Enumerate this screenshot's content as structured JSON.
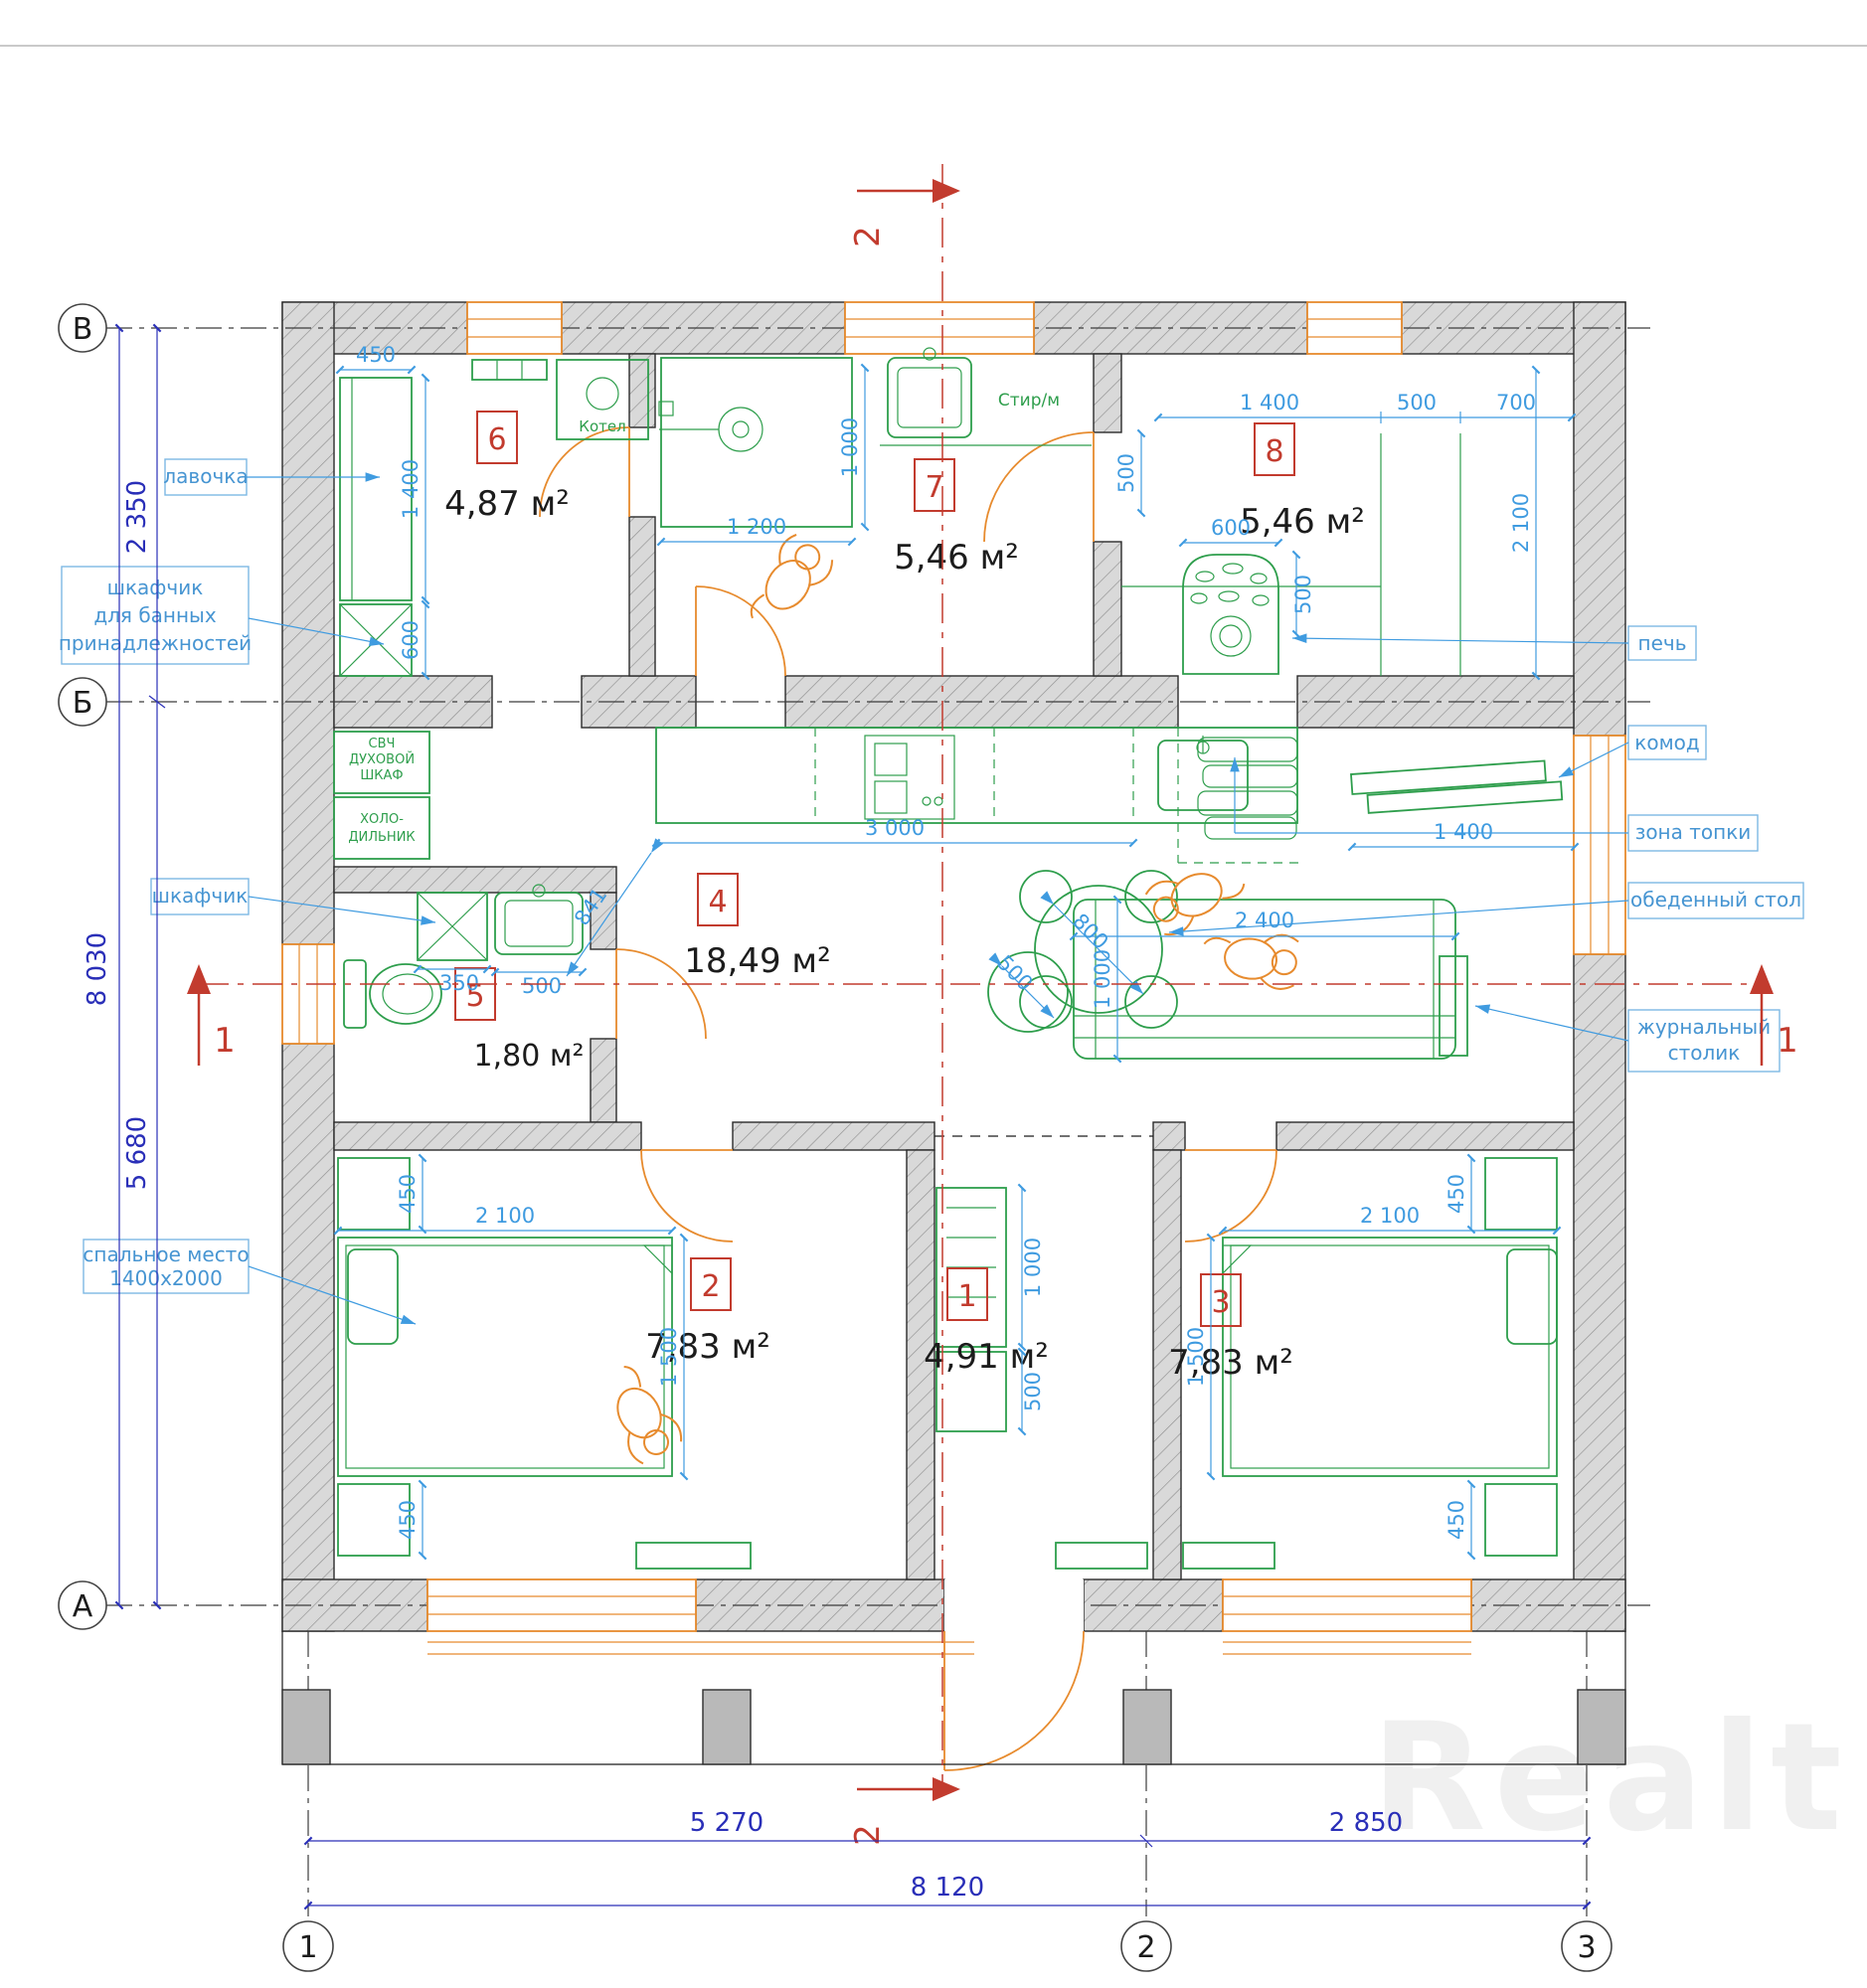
{
  "watermark": "Realt",
  "axes": {
    "vertical_letters": [
      "В",
      "Б",
      "А"
    ],
    "horizontal_numbers": [
      "1",
      "2",
      "3"
    ]
  },
  "sections": {
    "s1": "1",
    "s2": "2"
  },
  "rooms": [
    {
      "num": "1",
      "area": "4,91 м²"
    },
    {
      "num": "2",
      "area": "7,83 м²"
    },
    {
      "num": "3",
      "area": "7,83 м²"
    },
    {
      "num": "4",
      "area": "18,49 м²"
    },
    {
      "num": "5",
      "area": "1,80 м²"
    },
    {
      "num": "6",
      "area": "4,87 м²"
    },
    {
      "num": "7",
      "area": "5,46 м²"
    },
    {
      "num": "8",
      "area": "5,46 м²"
    }
  ],
  "callouts": {
    "lavochka": "лавочка",
    "bath_cabinet": [
      "шкафчик",
      "для банных",
      "принадлежностей"
    ],
    "shkafchik": "шкафчик",
    "sleeping": [
      "спальное место",
      "1400х2000"
    ],
    "pech": "печь",
    "komod": "комод",
    "zona_topki": "зона топки",
    "dining_table": "обеденный стол",
    "coffee_table": [
      "журнальный",
      "столик"
    ]
  },
  "equipment": {
    "kotel": "Котел",
    "stir": "Стир/м",
    "svch": [
      "СВЧ",
      "ДУХОВОЙ",
      "ШКАФ"
    ],
    "fridge": [
      "ХОЛО-",
      "ДИЛЬНИК"
    ]
  },
  "dims": {
    "d350": "350",
    "d450": "450",
    "d500": "500",
    "d600": "600",
    "d700": "700",
    "d800": "800",
    "d841": "841",
    "d1000": "1 000",
    "d1200": "1 200",
    "d1400": "1 400",
    "d1500": "1 500",
    "d2100": "2 100",
    "d2400": "2 400",
    "d3000": "3 000",
    "d2350": "2 350",
    "d5680": "5 680",
    "d8030": "8 030",
    "d5270": "5 270",
    "d2850": "2 850",
    "d8120": "8 120"
  },
  "colors": {
    "green": "#2e9e4c",
    "orange": "#e78b2e",
    "dim_blue": "#3f9be0",
    "main_blue": "#2a2fb8",
    "red": "#c23b2e",
    "wall_gray": "#d9d9d9"
  }
}
